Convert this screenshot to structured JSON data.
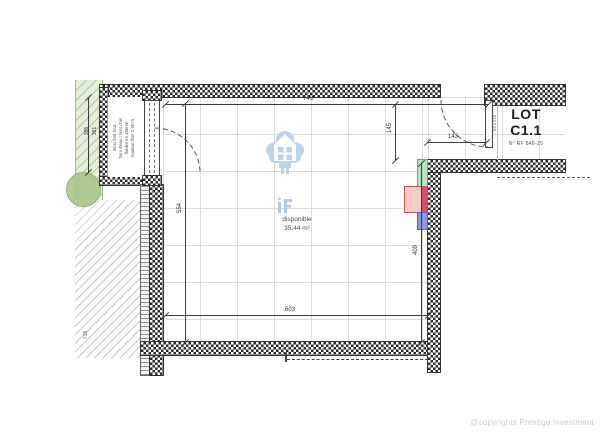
{
  "lot": {
    "title_line1": "LOT",
    "title_line2": "C1.1",
    "reference": "N° RF 848-25"
  },
  "unit": {
    "status": "disponible",
    "area": "35,44 m²"
  },
  "dimensions": {
    "top_width": "743",
    "left_height": "554",
    "bottom_width": "603",
    "right_height": "409",
    "entry_recess": "145",
    "door_opening": "143",
    "outer_left_a": "365",
    "outer_left_b": "361",
    "outer_bottom": "718"
  },
  "door_note": "93 x 215",
  "annex_note_lines": [
    "local livré brut",
    "hors d'eau / hors d'air",
    "fluides en attente",
    "hauteur libre 2,60 m"
  ],
  "footer": {
    "copyright": "@copyrights Prestige Investment"
  },
  "icons": {
    "watermark": "house-logo-watermark",
    "monogram": "brand-monogram"
  },
  "colors": {
    "watermark_blue": "#b8cfe7",
    "wall_dark": "#2a2a2a",
    "marker_green": "#b7e4c0",
    "marker_pink": "#f5cdc7",
    "marker_crimson": "#d44e70",
    "marker_blue": "#9099dc",
    "landscape_green": "#e4eed8"
  }
}
